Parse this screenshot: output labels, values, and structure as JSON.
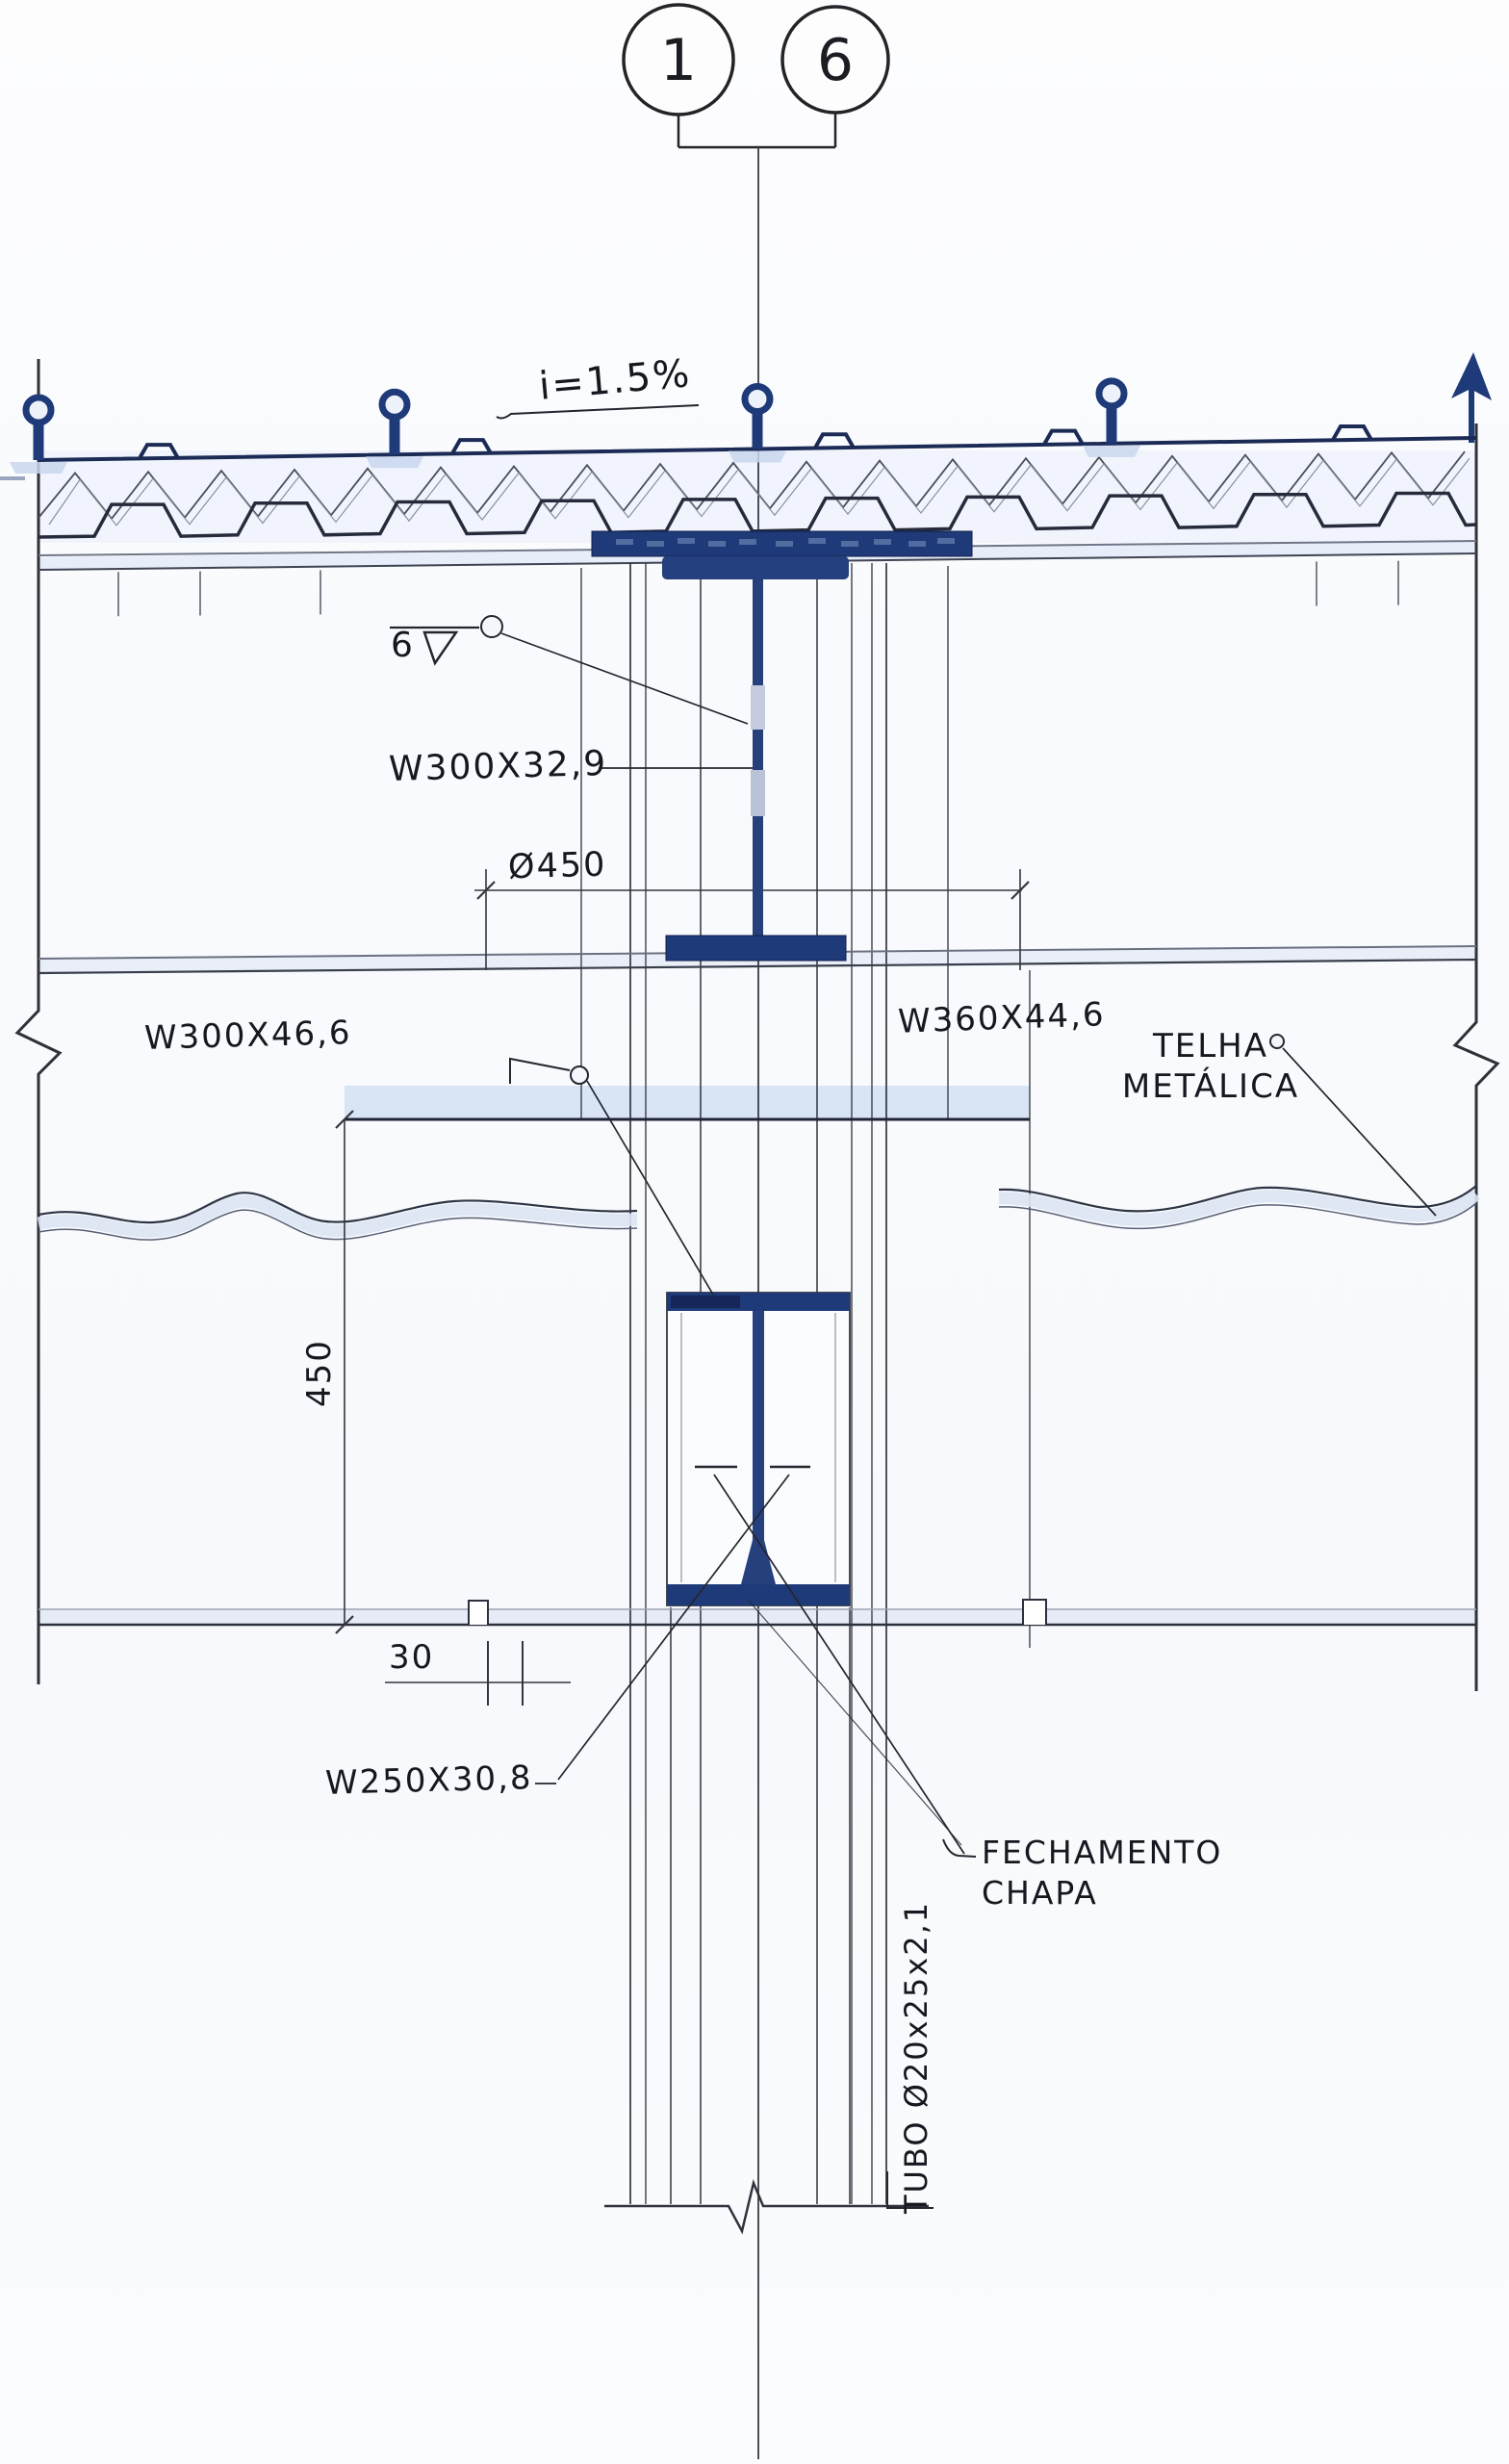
{
  "drawing": {
    "grid_bubbles": {
      "left": "1",
      "right": "6"
    },
    "labels": {
      "slope": "i=1.5%",
      "weld_size": "6",
      "beam_top": "W300X32,9",
      "dim_width": "Ø450",
      "beam_left": "W300X46,6",
      "beam_right": "W360X44,6",
      "roof_sheet_line1": "TELHA",
      "roof_sheet_line2": "METÁLICA",
      "dim_height": "450",
      "dim_gap": "30",
      "beam_lower": "W250X30,8",
      "closure_line1": "FECHAMENTO",
      "closure_line2": "CHAPA",
      "tube": "TUBO Ø20x25x2,1"
    },
    "colors": {
      "steel": "#1e3a78",
      "line": "#23262e",
      "wash": "#dce6f5"
    }
  }
}
